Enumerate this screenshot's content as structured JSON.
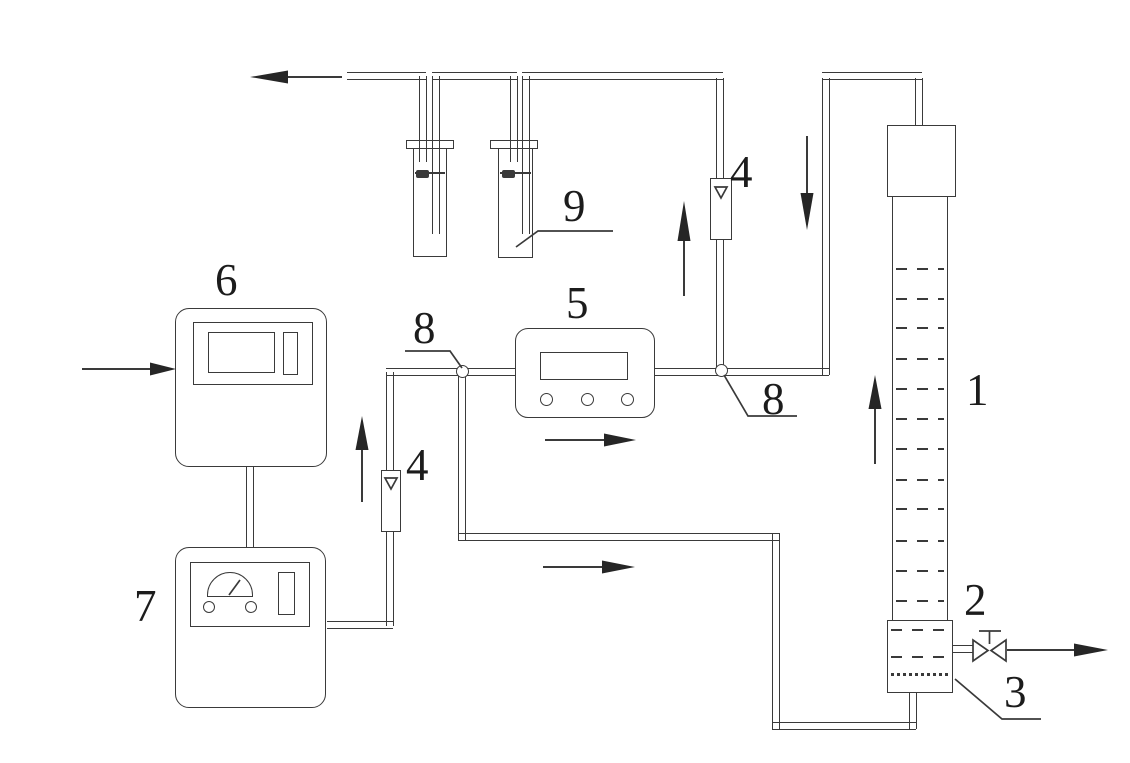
{
  "colors": {
    "line": "#3a3a3a",
    "arrow": "#262626",
    "text": "#1c1c1c",
    "background": "#ffffff"
  },
  "labels": {
    "column": "1",
    "valve": "2",
    "distributor": "3",
    "flowmeter_left": "4",
    "flowmeter_right": "4",
    "analyzer": "5",
    "instrument_top": "6",
    "instrument_bottom": "7",
    "junction_left": "8",
    "junction_right": "8",
    "bottles": "9"
  }
}
